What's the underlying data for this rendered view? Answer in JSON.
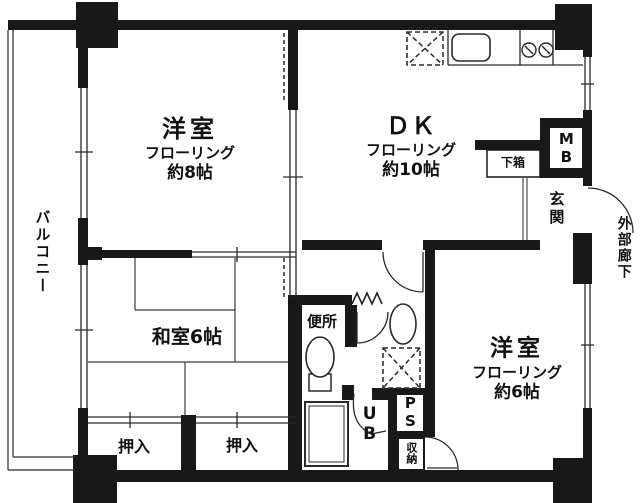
{
  "colors": {
    "wall": "#181818",
    "line": "#2a2a2a",
    "bg": "#ffffff"
  },
  "rooms": {
    "western_room_8": {
      "name": "洋室",
      "floor": "フローリング",
      "size": "約8帖"
    },
    "dining_kitchen": {
      "name": "ＤＫ",
      "floor": "フローリング",
      "size": "約10帖"
    },
    "western_room_6": {
      "name": "洋室",
      "floor": "フローリング",
      "size": "約6帖"
    },
    "japanese_room": {
      "name": "和室6帖"
    },
    "balcony": {
      "name": "バルコニー"
    },
    "entrance": {
      "name": "玄関"
    },
    "exterior_corridor": {
      "name": "外部廊下"
    },
    "toilet": {
      "name": "便所"
    },
    "unit_bath": {
      "name": "UB"
    },
    "closet_left": {
      "name": "押入"
    },
    "closet_right": {
      "name": "押入"
    },
    "storage": {
      "name": "収納"
    },
    "pipe_space": {
      "name": "PS"
    },
    "meter_box": {
      "name": "MB"
    },
    "shoe_cabinet": {
      "name": "下箱"
    }
  },
  "fixtures": {
    "kitchen_sink": "sink-icon",
    "gas_stove": "two-burner-stove-icon",
    "refrigerator_space": "dashed-x-box-icon",
    "washing_machine_space": "dashed-x-box-icon",
    "washbasin": "oval-basin-icon",
    "toilet_bowl": "toilet-icon",
    "bathtub": "bathtub-icon"
  }
}
